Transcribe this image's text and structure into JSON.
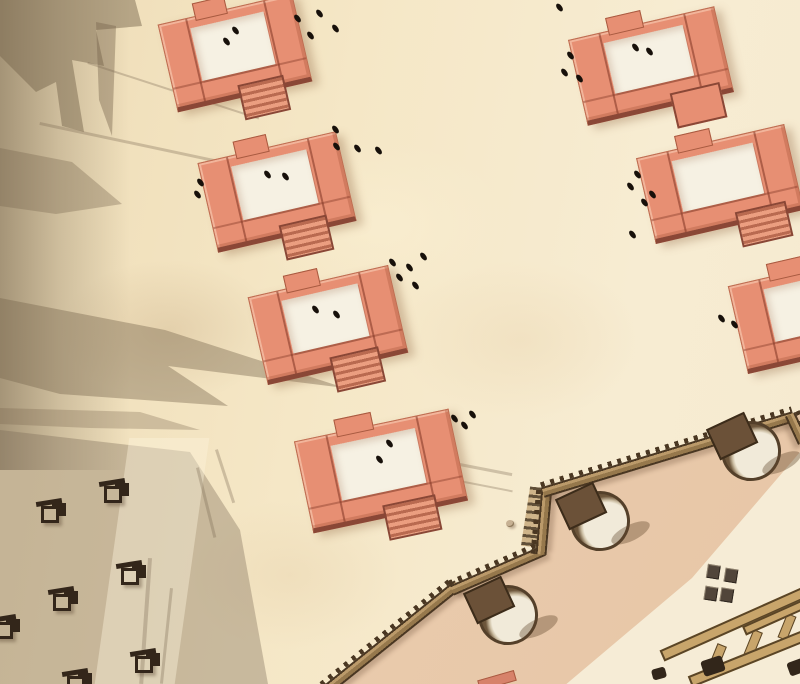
{
  "colors": {
    "roof": "#e78f73",
    "roof_edge": "#8a4736",
    "yard": "#f6f1e3",
    "stair_dark": "#b96a50",
    "stair_light": "#eb9e80",
    "wall_light": "#bb9a6a",
    "wall_mid": "#96784c",
    "wall_dark": "#4a3722",
    "pav_pink": "#ecd0b4",
    "pav_pink2": "#e7c6a6",
    "pav_light": "#f6ecd6",
    "tower_plate": "#6b5138",
    "tower_dome": "#f1ead9",
    "dome_shade": "#cdbfa4",
    "tower_ring": "#54402a",
    "wood": "#c8a56b",
    "wood_dark": "#5a4526",
    "person": "#17100a",
    "stall": "#33261a"
  },
  "buildings": [
    {
      "x": 166,
      "y": 8,
      "w": 136,
      "h": 84,
      "rot": -13,
      "stairs": "striped"
    },
    {
      "x": 206,
      "y": 146,
      "w": 140,
      "h": 86,
      "rot": -13,
      "stairs": "striped"
    },
    {
      "x": 256,
      "y": 280,
      "w": 142,
      "h": 84,
      "rot": -13,
      "stairs": "striped"
    },
    {
      "x": 302,
      "y": 424,
      "w": 156,
      "h": 88,
      "rot": -12,
      "stairs": "striped"
    },
    {
      "x": 576,
      "y": 22,
      "w": 148,
      "h": 82,
      "rot": -13,
      "stairs": "plain",
      "stairs_left": 58
    },
    {
      "x": 644,
      "y": 140,
      "w": 150,
      "h": 82,
      "rot": -13,
      "stairs": "striped",
      "stairs_left": 55
    },
    {
      "x": 736,
      "y": 268,
      "w": 150,
      "h": 84,
      "rot": -13,
      "stairs": "striped"
    }
  ],
  "wall_segments": [
    {
      "x1": 326,
      "y1": 690,
      "x2": 458,
      "y2": 584
    },
    {
      "x1": 452,
      "y1": 590,
      "x2": 544,
      "y2": 550
    },
    {
      "x1": 541,
      "y1": 554,
      "x2": 547,
      "y2": 486
    },
    {
      "x1": 543,
      "y1": 492,
      "x2": 794,
      "y2": 416
    },
    {
      "x1": 790,
      "y1": 414,
      "x2": 803,
      "y2": 442
    }
  ],
  "towers": [
    {
      "x": 505,
      "y": 612
    },
    {
      "x": 597,
      "y": 518
    },
    {
      "x": 748,
      "y": 448
    }
  ],
  "stalls": [
    {
      "x": 36,
      "y": 498
    },
    {
      "x": 99,
      "y": 478
    },
    {
      "x": 48,
      "y": 586
    },
    {
      "x": 116,
      "y": 560
    },
    {
      "x": 130,
      "y": 648
    },
    {
      "x": 62,
      "y": 668
    },
    {
      "x": -10,
      "y": 614
    }
  ],
  "people": [
    [
      295,
      14
    ],
    [
      317,
      9
    ],
    [
      333,
      24
    ],
    [
      308,
      31
    ],
    [
      233,
      26
    ],
    [
      224,
      37
    ],
    [
      557,
      3
    ],
    [
      568,
      51
    ],
    [
      562,
      68
    ],
    [
      577,
      74
    ],
    [
      633,
      43
    ],
    [
      647,
      47
    ],
    [
      198,
      178
    ],
    [
      195,
      190
    ],
    [
      265,
      170
    ],
    [
      283,
      172
    ],
    [
      333,
      125
    ],
    [
      334,
      142
    ],
    [
      355,
      144
    ],
    [
      376,
      146
    ],
    [
      421,
      252
    ],
    [
      390,
      258
    ],
    [
      407,
      263
    ],
    [
      397,
      273
    ],
    [
      413,
      281
    ],
    [
      313,
      305
    ],
    [
      334,
      310
    ],
    [
      635,
      170
    ],
    [
      628,
      182
    ],
    [
      650,
      190
    ],
    [
      642,
      198
    ],
    [
      630,
      230
    ],
    [
      719,
      314
    ],
    [
      732,
      320
    ],
    [
      452,
      414
    ],
    [
      462,
      421
    ],
    [
      470,
      410
    ],
    [
      387,
      439
    ],
    [
      377,
      455
    ]
  ]
}
